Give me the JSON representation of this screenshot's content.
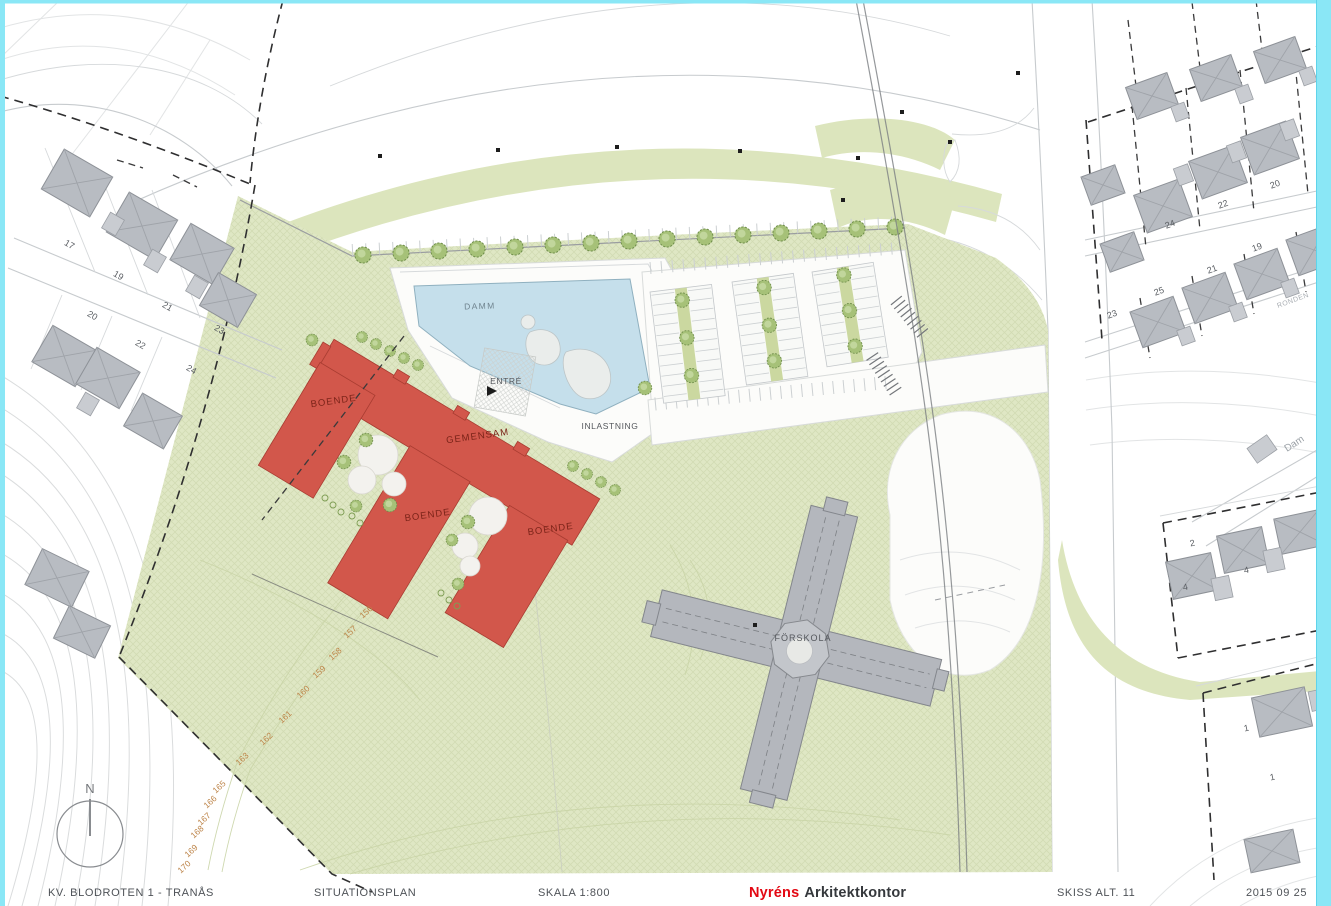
{
  "title_bar": {
    "project": "KV. BLODROTEN 1 - TRANÅS",
    "drawing_type": "SITUATIONSPLAN",
    "scale": "SKALA 1:800",
    "firm_red_part": "Nyréns",
    "firm_black_part": "Arkitektkontor",
    "sketch_alt": "SKISS ALT. 11",
    "date": "2015 09 25"
  },
  "labels": {
    "pond": "DAMM",
    "entrance": "ENTRÉ",
    "common": "GEMENSAM",
    "loading": "INLASTNING",
    "housing_left": "BOENDE",
    "housing_mid": "BOENDE",
    "housing_right": "BOENDE",
    "preschool": "FÖRSKOLA",
    "north": "N",
    "street_dam": "Dam",
    "street_ronden": "RONDEN"
  },
  "contour_elevations": [
    "156",
    "157",
    "158",
    "159",
    "160",
    "161",
    "162",
    "163",
    "164",
    "165",
    "166",
    "167",
    "168",
    "169",
    "170"
  ],
  "left_plot_numbers": [
    "17",
    "19",
    "21",
    "23",
    "20",
    "22",
    "24"
  ],
  "right_plot_numbers_row1": [
    "24",
    "22",
    "20"
  ],
  "right_plot_numbers_row2": [
    "23",
    "25",
    "21",
    "19"
  ],
  "right_house_numbers": [
    "2",
    "4",
    "4",
    "1",
    "1"
  ],
  "colors": {
    "border_cyan": "#8AE7F6",
    "site_green": "#DFE7C4",
    "parking_island_green": "#CBD8A0",
    "building_red": "#D2574B",
    "building_red_label": "#7A2318",
    "pond_blue": "#C5DFEB",
    "preschool_gray": "#B4B7BD",
    "house_gray": "#B8BCC2",
    "contour_label_orange": "#BD8448",
    "firm_logo_red": "#E30813",
    "ink": "#4E5257"
  }
}
